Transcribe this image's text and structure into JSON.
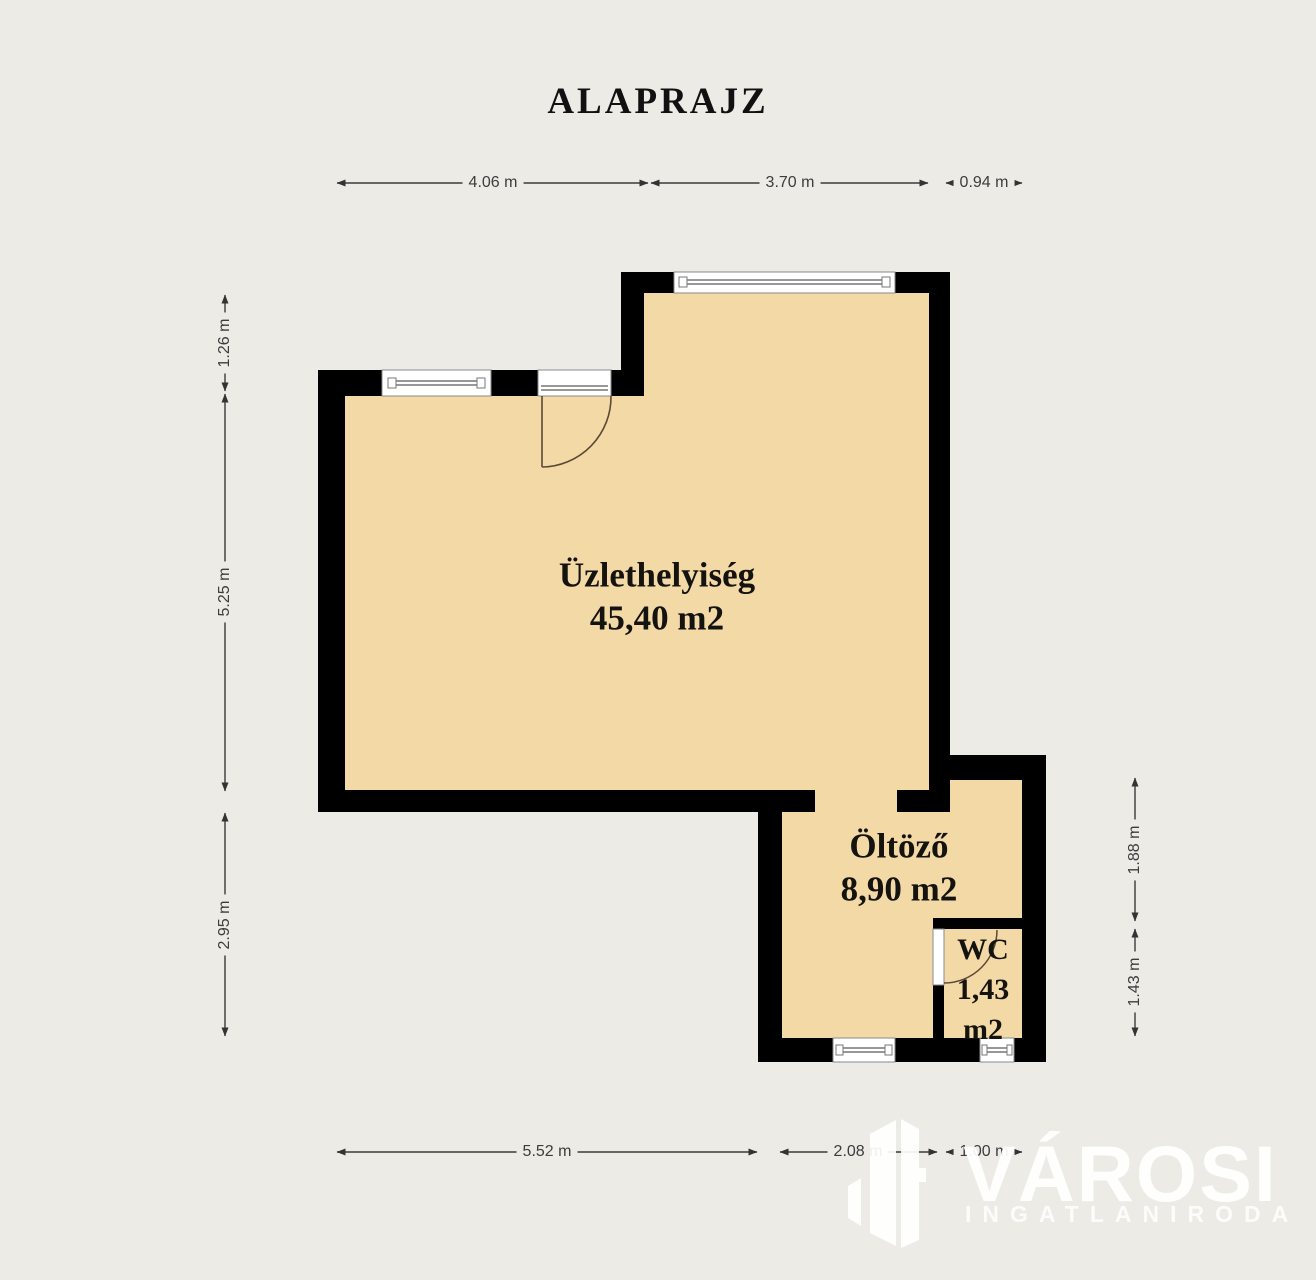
{
  "title": "ALAPRAJZ",
  "rooms": [
    {
      "name": "Üzlethelyiség",
      "area": "45,40 m2"
    },
    {
      "name": "Öltöző",
      "area": "8,90 m2"
    },
    {
      "name": "WC",
      "area_line1": "1,43",
      "area_line2": "m2"
    }
  ],
  "dimensions": {
    "top": [
      "4.06 m",
      "3.70 m",
      "0.94 m"
    ],
    "left": [
      "1.26 m",
      "5.25 m",
      "2.95 m"
    ],
    "right": [
      "1.88 m",
      "1.43 m"
    ],
    "bottom": [
      "5.52 m",
      "2.08 m",
      "1.00 m"
    ]
  },
  "logo": {
    "brand": "VÁROSI",
    "subtitle": "INGATLANIRODA"
  },
  "colors": {
    "background": "#edebe6",
    "floor_fill": "#f3d9a6",
    "wall": "#000000",
    "dimension_line": "#3a3a3a",
    "logo": "#ffffff"
  }
}
